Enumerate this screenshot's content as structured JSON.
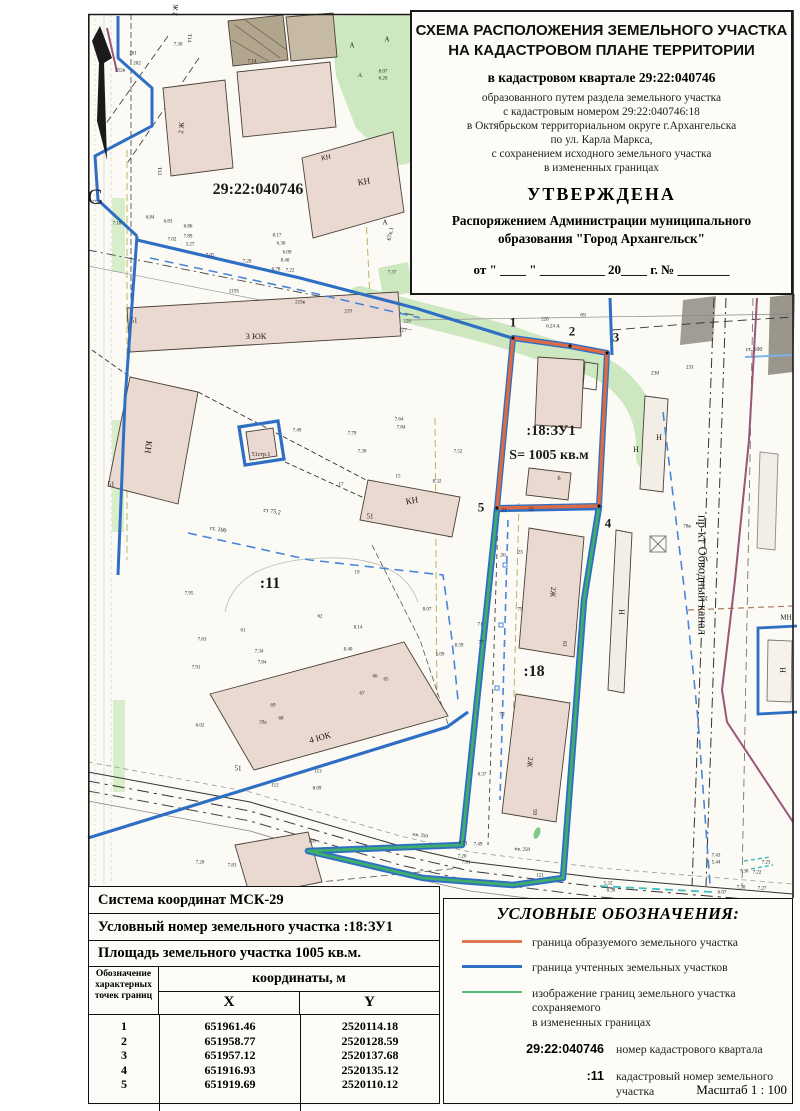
{
  "title_block": {
    "heading_line1": "СХЕМА РАСПОЛОЖЕНИЯ ЗЕМЕЛЬНОГО УЧАСТКА",
    "heading_line2": "НА КАДАСТРОВОМ ПЛАНЕ ТЕРРИТОРИИ",
    "subtitle": "в кадастровом квартале 29:22:040746",
    "body_lines": [
      "образованного путем раздела земельного участка",
      "с кадастровым номером 29:22:040746:18",
      "в Октябрьском территориальном округе г.Архангельска",
      "по ул. Карла Маркса,",
      "с сохранением исходного земельного участка",
      "в измененных границах"
    ],
    "approved": "УТВЕРЖДЕНА",
    "approved_by_line1": "Распоряжением Администрации муниципального",
    "approved_by_line2": "образования \"Город Архангельск\"",
    "date_line": "от \" ____ \" __________ 20____ г. № ________"
  },
  "coords_block": {
    "crs_line": "Система координат МСК-29",
    "number_line": "Условный номер земельного участка  :18:ЗУ1",
    "area_line": "Площадь земельного участка 1005 кв.м.",
    "table": {
      "point_col_header": "Обозначение характерных точек границ",
      "coords_header": "координаты, м",
      "x_header": "X",
      "y_header": "Y",
      "rows": [
        {
          "n": "1",
          "x": "651961.46",
          "y": "2520114.18"
        },
        {
          "n": "2",
          "x": "651958.77",
          "y": "2520128.59"
        },
        {
          "n": "3",
          "x": "651957.12",
          "y": "2520137.68"
        },
        {
          "n": "4",
          "x": "651916.93",
          "y": "2520135.12"
        },
        {
          "n": "5",
          "x": "651919.69",
          "y": "2520110.12"
        }
      ]
    }
  },
  "legend": {
    "title": "УСЛОВНЫЕ ОБОЗНАЧЕНИЯ:",
    "line_items": [
      {
        "color": "#dd7a52",
        "label": "граница образуемого земельного участка",
        "label2": ""
      },
      {
        "color": "#2f6fc3",
        "label": "граница учтенных земельных участков",
        "label2": ""
      },
      {
        "color": "#52bb74",
        "label": "изображение границ земельного участка сохраняемого",
        "label2": "в измененных границах"
      }
    ],
    "symbol_items": [
      {
        "symbol": "29:22:040746",
        "label": "номер кадастрового квартала"
      },
      {
        "symbol": ":11",
        "label": "кадастровый номер земельного участка"
      },
      {
        "symbol": ":18:ЗУ1",
        "label": "условный номер  образуемого земельного участка"
      }
    ],
    "scale_label": "Масштаб 1 : 100"
  },
  "colors": {
    "formed_boundary": "#dc6a44",
    "registered_boundary": "#2f6fc3",
    "preserved_boundary": "#3fae6a",
    "quarter_line": "#9a5577",
    "greenery": "#cde8c0",
    "building_fill": "#ead9d0"
  },
  "map": {
    "labels": [
      {
        "t": "С",
        "x": 95,
        "y": 197,
        "s": 22,
        "n": "north-label"
      },
      {
        "t": "29:22:040746",
        "x": 258,
        "y": 190,
        "s": 16,
        "b": 1,
        "n": "cadastral-quarter-label"
      },
      {
        "t": ":18:ЗУ1",
        "x": 551,
        "y": 431,
        "s": 14.5,
        "b": 1,
        "n": "new-parcel-label"
      },
      {
        "t": "S= 1005 кв.м",
        "x": 549,
        "y": 456,
        "s": 14,
        "b": 1,
        "n": "new-parcel-area-label"
      },
      {
        "t": ":11",
        "x": 270,
        "y": 584,
        "s": 16,
        "b": 1,
        "n": "parcel-11-label"
      },
      {
        "t": ":18",
        "x": 534,
        "y": 672,
        "s": 16,
        "b": 1,
        "n": "parcel-18-label"
      },
      {
        "t": "1",
        "x": 513,
        "y": 322,
        "s": 13,
        "b": 1,
        "n": "boundary-point-1"
      },
      {
        "t": "2",
        "x": 572,
        "y": 331,
        "s": 13,
        "b": 1,
        "n": "boundary-point-2"
      },
      {
        "t": "3",
        "x": 616,
        "y": 337,
        "s": 13,
        "b": 1,
        "n": "boundary-point-3"
      },
      {
        "t": "4",
        "x": 608,
        "y": 523,
        "s": 13,
        "b": 1,
        "n": "boundary-point-4"
      },
      {
        "t": "5",
        "x": 481,
        "y": 507,
        "s": 13,
        "b": 1,
        "n": "boundary-point-5"
      },
      {
        "t": "пр-кт Обводный канал",
        "x": 702,
        "y": 575,
        "s": 12.5,
        "r": 90,
        "n": "street-label"
      },
      {
        "t": "3 ЮК",
        "x": 256,
        "y": 336,
        "s": 8.5
      },
      {
        "t": "4 ЮК",
        "x": 320,
        "y": 738,
        "s": 9,
        "r": -16
      },
      {
        "t": "2 Ж",
        "x": 176,
        "y": 10,
        "s": 7,
        "r": -85
      },
      {
        "t": "2 Ж",
        "x": 182,
        "y": 128,
        "s": 7,
        "r": -85
      },
      {
        "t": "КН",
        "x": 364,
        "y": 182,
        "s": 9,
        "r": -10
      },
      {
        "t": "КН",
        "x": 326,
        "y": 158,
        "s": 7,
        "r": -10
      },
      {
        "t": "КН",
        "x": 148,
        "y": 447,
        "s": 9,
        "r": 97
      },
      {
        "t": "КН",
        "x": 412,
        "y": 501,
        "s": 9,
        "r": -10
      },
      {
        "t": "2Ж",
        "x": 553,
        "y": 592,
        "s": 7.5,
        "r": 95
      },
      {
        "t": "2Ж",
        "x": 530,
        "y": 762,
        "s": 7.5,
        "r": 95
      },
      {
        "t": "Н",
        "x": 636,
        "y": 450,
        "s": 8
      },
      {
        "t": "Н",
        "x": 659,
        "y": 438,
        "s": 8
      },
      {
        "t": "Н",
        "x": 621,
        "y": 612,
        "s": 8,
        "r": 90
      },
      {
        "t": "Н",
        "x": 782,
        "y": 670,
        "s": 8,
        "r": 90
      },
      {
        "t": "МН",
        "x": 786,
        "y": 618,
        "s": 7
      },
      {
        "t": "51",
        "x": 111,
        "y": 485,
        "s": 7
      },
      {
        "t": "51",
        "x": 134,
        "y": 321,
        "s": 7
      },
      {
        "t": "51",
        "x": 370,
        "y": 517,
        "s": 7
      },
      {
        "t": "51",
        "x": 238,
        "y": 769,
        "s": 7
      },
      {
        "t": "51стр.1",
        "x": 261,
        "y": 455,
        "s": 6
      },
      {
        "t": "61",
        "x": 564,
        "y": 644,
        "s": 6,
        "r": 90
      },
      {
        "t": "59",
        "x": 534,
        "y": 812,
        "s": 6,
        "r": 90
      },
      {
        "t": "67к.1",
        "x": 391,
        "y": 234,
        "s": 6,
        "r": -78
      },
      {
        "t": "б",
        "x": 559,
        "y": 479,
        "s": 6
      },
      {
        "t": "Т12",
        "x": 158,
        "y": 171,
        "s": 5.5,
        "r": 90
      },
      {
        "t": "Т14",
        "x": 188,
        "y": 38,
        "s": 5.5,
        "r": 90
      },
      {
        "t": "ст. 100",
        "x": 754,
        "y": 350,
        "s": 6
      },
      {
        "t": "ст 75.2",
        "x": 272,
        "y": 512,
        "s": 6,
        "r": 10
      },
      {
        "t": "ст. 100",
        "x": 218,
        "y": 530,
        "s": 6,
        "r": 10
      },
      {
        "t": "230",
        "x": 655,
        "y": 374,
        "s": 5.5
      },
      {
        "t": "231",
        "x": 690,
        "y": 368,
        "s": 5.5
      },
      {
        "t": "69",
        "x": 583,
        "y": 316,
        "s": 5.5
      },
      {
        "t": "228",
        "x": 545,
        "y": 320,
        "s": 5
      },
      {
        "t": "6.24 А",
        "x": 553,
        "y": 327,
        "s": 5
      },
      {
        "t": "А",
        "x": 352,
        "y": 46,
        "s": 7
      },
      {
        "t": "А",
        "x": 387,
        "y": 40,
        "s": 7
      },
      {
        "t": "А",
        "x": 385,
        "y": 223,
        "s": 7
      },
      {
        "t": "А",
        "x": 360,
        "y": 76,
        "s": 6
      },
      {
        "t": "8.07",
        "x": 383,
        "y": 72,
        "s": 5
      },
      {
        "t": "6.26",
        "x": 383,
        "y": 79,
        "s": 5
      },
      {
        "t": "201",
        "x": 133,
        "y": 54,
        "s": 5
      },
      {
        "t": "202",
        "x": 137,
        "y": 64,
        "s": 5
      },
      {
        "t": "252в",
        "x": 120,
        "y": 71,
        "s": 5
      },
      {
        "t": "2524",
        "x": 97,
        "y": 203,
        "s": 5
      },
      {
        "t": "7.30",
        "x": 178,
        "y": 45,
        "s": 5
      },
      {
        "t": "7.14",
        "x": 252,
        "y": 62,
        "s": 5
      },
      {
        "t": "6.84",
        "x": 150,
        "y": 218,
        "s": 5
      },
      {
        "t": "6.83",
        "x": 168,
        "y": 222,
        "s": 5
      },
      {
        "t": "6.86",
        "x": 188,
        "y": 227,
        "s": 5
      },
      {
        "t": "7.18",
        "x": 117,
        "y": 224,
        "s": 5
      },
      {
        "t": "7.02",
        "x": 172,
        "y": 240,
        "s": 5
      },
      {
        "t": "7.89",
        "x": 188,
        "y": 237,
        "s": 5
      },
      {
        "t": "3.27",
        "x": 190,
        "y": 245,
        "s": 5
      },
      {
        "t": "7.05",
        "x": 210,
        "y": 256,
        "s": 5
      },
      {
        "t": "7.20",
        "x": 247,
        "y": 262,
        "s": 5
      },
      {
        "t": "8.17",
        "x": 277,
        "y": 236,
        "s": 5
      },
      {
        "t": "6.36",
        "x": 281,
        "y": 244,
        "s": 5
      },
      {
        "t": "6.09",
        "x": 287,
        "y": 253,
        "s": 5
      },
      {
        "t": "8.40",
        "x": 285,
        "y": 261,
        "s": 5
      },
      {
        "t": "6.78",
        "x": 276,
        "y": 270,
        "s": 5
      },
      {
        "t": "7.22",
        "x": 290,
        "y": 271,
        "s": 5
      },
      {
        "t": "2195",
        "x": 234,
        "y": 292,
        "s": 5
      },
      {
        "t": "219в",
        "x": 300,
        "y": 303,
        "s": 5
      },
      {
        "t": "219",
        "x": 348,
        "y": 312,
        "s": 5
      },
      {
        "t": "227",
        "x": 403,
        "y": 331,
        "s": 5
      },
      {
        "t": "228",
        "x": 407,
        "y": 322,
        "s": 5
      },
      {
        "t": "7.37",
        "x": 392,
        "y": 273,
        "s": 5
      },
      {
        "t": "7.49",
        "x": 297,
        "y": 431,
        "s": 5
      },
      {
        "t": "7.79",
        "x": 352,
        "y": 434,
        "s": 5
      },
      {
        "t": "7.30",
        "x": 362,
        "y": 452,
        "s": 5
      },
      {
        "t": "7.64",
        "x": 399,
        "y": 420,
        "s": 5
      },
      {
        "t": "7.84",
        "x": 401,
        "y": 428,
        "s": 5
      },
      {
        "t": "7.52",
        "x": 458,
        "y": 452,
        "s": 5
      },
      {
        "t": "8.32",
        "x": 437,
        "y": 482,
        "s": 5
      },
      {
        "t": "15",
        "x": 398,
        "y": 477,
        "s": 5
      },
      {
        "t": "17",
        "x": 341,
        "y": 485,
        "s": 5
      },
      {
        "t": "19",
        "x": 357,
        "y": 573,
        "s": 5
      },
      {
        "t": "62",
        "x": 320,
        "y": 617,
        "s": 5
      },
      {
        "t": "61",
        "x": 243,
        "y": 631,
        "s": 5
      },
      {
        "t": "7.95",
        "x": 189,
        "y": 594,
        "s": 5
      },
      {
        "t": "7.63",
        "x": 202,
        "y": 640,
        "s": 5
      },
      {
        "t": "7.91",
        "x": 196,
        "y": 668,
        "s": 5
      },
      {
        "t": "7.34",
        "x": 259,
        "y": 652,
        "s": 5
      },
      {
        "t": "7.84",
        "x": 262,
        "y": 663,
        "s": 5
      },
      {
        "t": "8.40",
        "x": 348,
        "y": 650,
        "s": 5
      },
      {
        "t": "8.14",
        "x": 358,
        "y": 628,
        "s": 5
      },
      {
        "t": "8.07",
        "x": 427,
        "y": 610,
        "s": 5
      },
      {
        "t": "5.09",
        "x": 440,
        "y": 655,
        "s": 5
      },
      {
        "t": "8.39",
        "x": 459,
        "y": 646,
        "s": 5
      },
      {
        "t": "6.02",
        "x": 200,
        "y": 726,
        "s": 5
      },
      {
        "t": "66",
        "x": 375,
        "y": 677,
        "s": 5
      },
      {
        "t": "65",
        "x": 386,
        "y": 680,
        "s": 5
      },
      {
        "t": "67",
        "x": 362,
        "y": 694,
        "s": 5
      },
      {
        "t": "69",
        "x": 273,
        "y": 706,
        "s": 5
      },
      {
        "t": "68",
        "x": 281,
        "y": 719,
        "s": 5
      },
      {
        "t": "59а",
        "x": 263,
        "y": 723,
        "s": 5
      },
      {
        "t": "8.09",
        "x": 317,
        "y": 789,
        "s": 5
      },
      {
        "t": "112",
        "x": 275,
        "y": 786,
        "s": 5
      },
      {
        "t": "113",
        "x": 318,
        "y": 772,
        "s": 5
      },
      {
        "t": "110",
        "x": 312,
        "y": 842,
        "s": 5
      },
      {
        "t": "7.20",
        "x": 200,
        "y": 863,
        "s": 5
      },
      {
        "t": "7.83",
        "x": 232,
        "y": 866,
        "s": 5
      },
      {
        "t": "жв. 250",
        "x": 420,
        "y": 836,
        "s": 5,
        "r": 8
      },
      {
        "t": "жв. 250",
        "x": 522,
        "y": 850,
        "s": 5,
        "r": 4
      },
      {
        "t": "121",
        "x": 540,
        "y": 876,
        "s": 5
      },
      {
        "t": "5.32",
        "x": 608,
        "y": 884,
        "s": 5
      },
      {
        "t": "6.38",
        "x": 611,
        "y": 891,
        "s": 5
      },
      {
        "t": "6.07",
        "x": 722,
        "y": 893,
        "s": 5
      },
      {
        "t": "7.43",
        "x": 716,
        "y": 856,
        "s": 5
      },
      {
        "t": "5.44",
        "x": 716,
        "y": 863,
        "s": 5
      },
      {
        "t": "7.23",
        "x": 766,
        "y": 863,
        "s": 5
      },
      {
        "t": "7.30",
        "x": 744,
        "y": 872,
        "s": 5
      },
      {
        "t": "7.22",
        "x": 757,
        "y": 873,
        "s": 5
      },
      {
        "t": "7.30",
        "x": 741,
        "y": 888,
        "s": 5
      },
      {
        "t": "7.27",
        "x": 762,
        "y": 889,
        "s": 5
      },
      {
        "t": "7.71",
        "x": 463,
        "y": 844,
        "s": 5
      },
      {
        "t": "7.49",
        "x": 478,
        "y": 845,
        "s": 5
      },
      {
        "t": "7.20",
        "x": 462,
        "y": 857,
        "s": 5
      },
      {
        "t": "7.61",
        "x": 466,
        "y": 863,
        "s": 5
      },
      {
        "t": "6.37",
        "x": 482,
        "y": 775,
        "s": 5
      },
      {
        "t": "72",
        "x": 502,
        "y": 715,
        "s": 5.5
      },
      {
        "t": "77",
        "x": 481,
        "y": 643,
        "s": 5.5
      },
      {
        "t": "71",
        "x": 480,
        "y": 625,
        "s": 5.5
      },
      {
        "t": "26",
        "x": 503,
        "y": 556,
        "s": 5.5
      },
      {
        "t": "23",
        "x": 520,
        "y": 553,
        "s": 5.5
      },
      {
        "t": "79",
        "x": 520,
        "y": 610,
        "s": 5.5
      },
      {
        "t": "21",
        "x": 504,
        "y": 511,
        "s": 5.5
      },
      {
        "t": "22",
        "x": 531,
        "y": 510,
        "s": 5.5
      },
      {
        "t": "78в",
        "x": 687,
        "y": 527,
        "s": 5
      }
    ]
  }
}
